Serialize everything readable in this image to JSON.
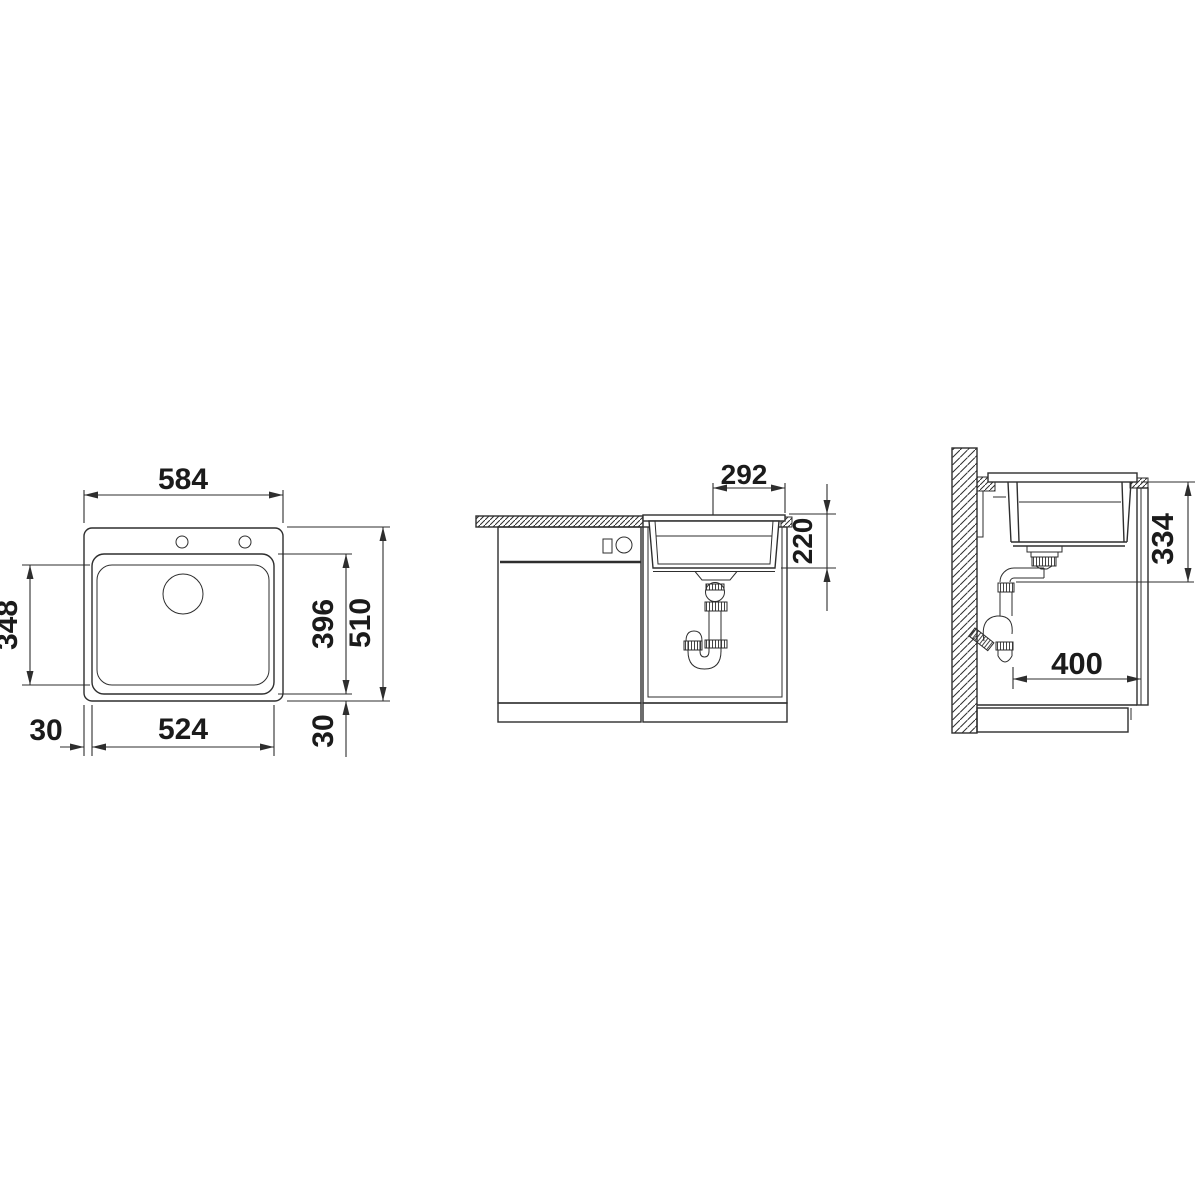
{
  "diagram": {
    "title_note": "",
    "top_view": {
      "outer_width": "584",
      "inner_height": "348",
      "bowl_height": "396",
      "outer_height": "510",
      "bowl_width": "524",
      "rim_left": "30",
      "rim_bottom": "30"
    },
    "front_view": {
      "drain_offset": "292",
      "bowl_depth": "220"
    },
    "side_view": {
      "drain_height": "334",
      "wall_clearance": "400"
    },
    "colors": {
      "line": "#2e2e2e",
      "text": "#1b1b1b",
      "background": "#ffffff"
    }
  }
}
